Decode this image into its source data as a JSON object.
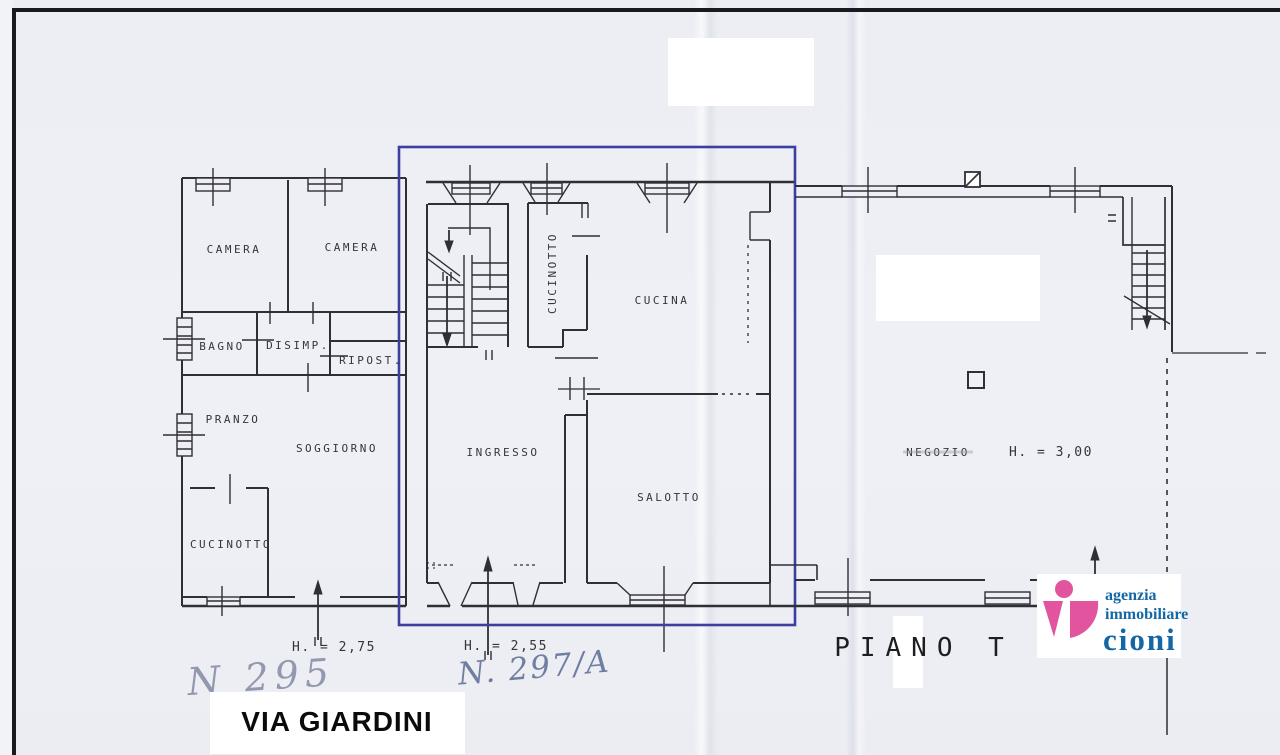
{
  "plan": {
    "left_unit": {
      "camera1": "CAMERA",
      "camera2": "CAMERA",
      "bagno": "BAGNO",
      "disimp": "DISIMP.",
      "ripost": "RIPOST.",
      "pranzo": "PRANZO",
      "soggiorno": "SOGGIORNO",
      "cucinotto": "CUCINOTTO",
      "height": "H. = 2,75"
    },
    "middle_unit": {
      "cucinotto": "CUCINOTTO",
      "cucina": "CUCINA",
      "ingresso": "INGRESSO",
      "salotto": "SALOTTO",
      "height": "H. = 2,55"
    },
    "right_unit": {
      "negozio": "NEGOZIO",
      "height": "H. = 3,00"
    },
    "floor": "PIANO T",
    "street": "VIA GIARDINI",
    "annotations": {
      "left_number": "N 295",
      "right_number": "N. 297/A"
    }
  },
  "logo": {
    "line1": "agenzia",
    "line2": "immobiliare",
    "line3": "cioni"
  },
  "colors": {
    "plan_line": "#2f2f35",
    "highlight_box": "#3c3f9e",
    "logo_pink": "#e2559e",
    "logo_blue": "#1568a6",
    "paper": "#edeff5"
  }
}
